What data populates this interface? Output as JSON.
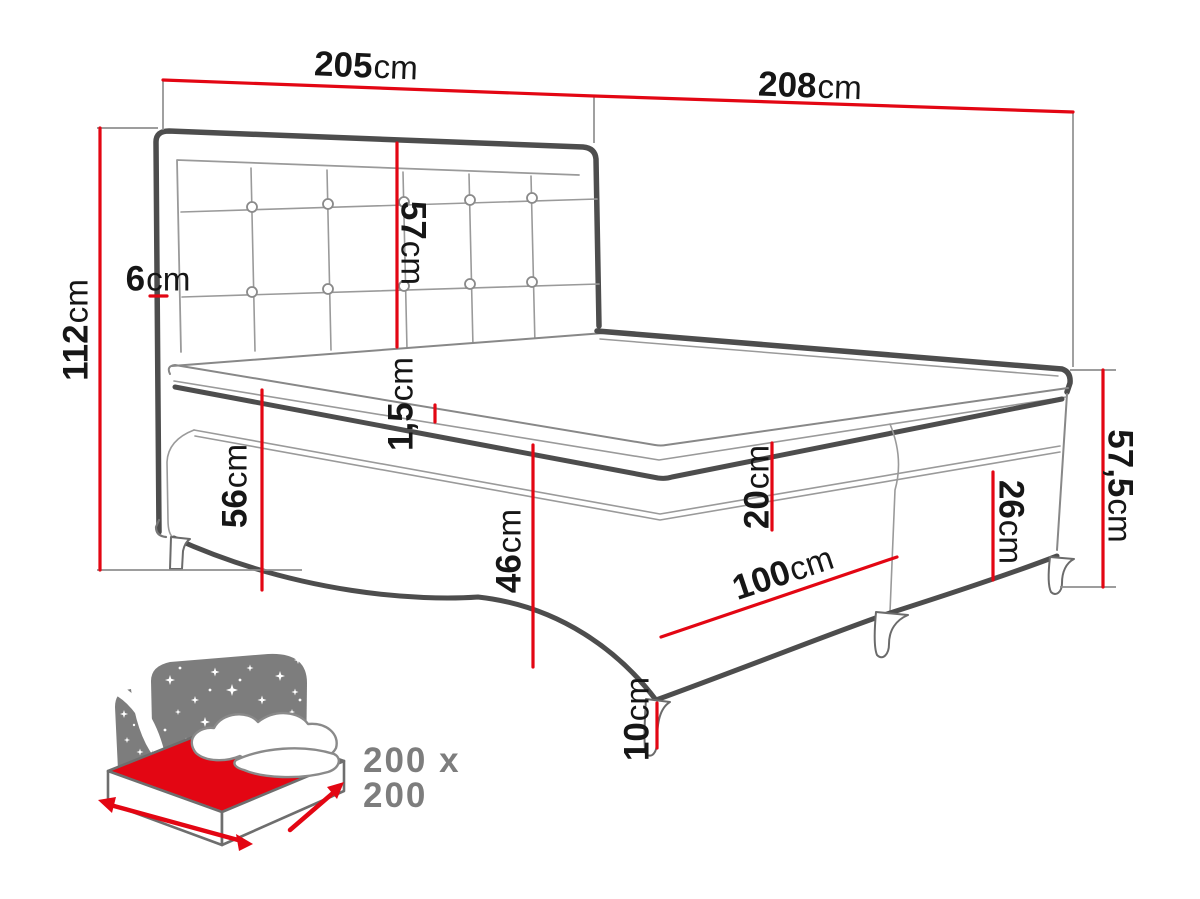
{
  "diagram": {
    "dims": {
      "w205": {
        "value": "205",
        "unit": "cm"
      },
      "w208": {
        "value": "208",
        "unit": "cm"
      },
      "h112": {
        "value": "112",
        "unit": "cm"
      },
      "t6": {
        "value": "6",
        "unit": "cm"
      },
      "h57": {
        "value": "57",
        "unit": "cm"
      },
      "t15": {
        "value": "1,5",
        "unit": "cm"
      },
      "h56": {
        "value": "56",
        "unit": "cm"
      },
      "h46": {
        "value": "46",
        "unit": "cm"
      },
      "h20": {
        "value": "20",
        "unit": "cm"
      },
      "l100": {
        "value": "100",
        "unit": "cm"
      },
      "h26": {
        "value": "26",
        "unit": "cm"
      },
      "h575": {
        "value": "57,5",
        "unit": "cm"
      },
      "h10": {
        "value": "10",
        "unit": "cm"
      }
    },
    "badge": {
      "label": "200 x 200"
    },
    "colors": {
      "dimension_red": "#e30613",
      "line_dark": "#4d4d4d",
      "line_light": "#9a9a9a",
      "icon_gray": "#7d7d7d",
      "text_dark": "#161616"
    }
  }
}
